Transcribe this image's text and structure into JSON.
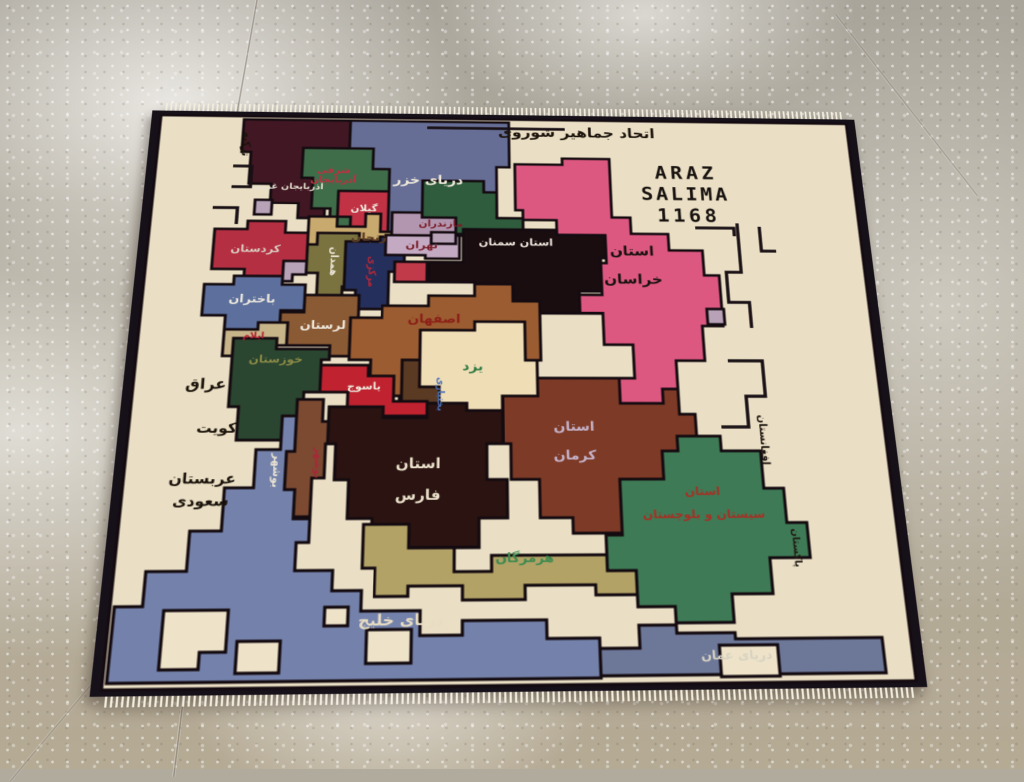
{
  "scene": {
    "floor_base_color": "#b1ab9e",
    "rug_field_color": "#eadfc4",
    "rug_border_color": "#161019",
    "fringe_color": "#f3edde"
  },
  "rug": {
    "regions": {
      "field": {
        "color": "#eadfc4"
      },
      "caspian": {
        "color": "#666e96"
      },
      "w_azerbaijan": {
        "color": "#401722"
      },
      "e_azerbaijan": {
        "color": "#3f6d4a"
      },
      "gilan": {
        "color": "#c03244"
      },
      "zanjan": {
        "color": "#c9aa6e"
      },
      "kurdistan": {
        "color": "#b52f42"
      },
      "hamadan": {
        "color": "#7a7340"
      },
      "markazi": {
        "color": "#252f5c"
      },
      "bakhtaran": {
        "color": "#5d6f9c"
      },
      "ilam": {
        "color": "#c8b489"
      },
      "lorestan": {
        "color": "#8a5a35"
      },
      "mazandaran": {
        "color": "#b295ae"
      },
      "tehran": {
        "color": "#c3a9c2"
      },
      "qom": {
        "color": "#c13a4a"
      },
      "gorgan": {
        "color": "#2f5c3c"
      },
      "semnan": {
        "color": "#190d10"
      },
      "khorasan": {
        "color": "#dd5880"
      },
      "esfahan": {
        "color": "#9a5c30"
      },
      "chaharmahal": {
        "color": "#5b3a24"
      },
      "yazd": {
        "color": "#efddb6"
      },
      "yasuj": {
        "color": "#c0232f"
      },
      "khuzestan": {
        "color": "#2a4530"
      },
      "bushehr": {
        "color": "#7b4a31"
      },
      "fars": {
        "color": "#2a1310"
      },
      "kerman": {
        "color": "#7d3a26"
      },
      "sistan": {
        "color": "#3e7a55"
      },
      "hormozgan": {
        "color": "#b2a266"
      },
      "gulf": {
        "color": "#7482ab"
      },
      "oman": {
        "color": "#6d7899"
      },
      "island": {
        "color": "#eee3c8"
      },
      "mauve_patch": {
        "color": "#b8a2b8"
      }
    },
    "labels": [
      {
        "id": "ussr",
        "text": "اتحاد جماهیر شوروی",
        "x": 465,
        "y": 24,
        "size": 17,
        "color": "#1c140c",
        "ls": 6
      },
      {
        "id": "turkey",
        "text": "ترکیه",
        "x": 104,
        "y": 42,
        "size": 12,
        "color": "#1c140c",
        "vertical": true
      },
      {
        "id": "araz-line1",
        "text": "ARAZ",
        "x": 584,
        "y": 74,
        "size": 22,
        "color": "#181310",
        "latin": true,
        "ls": 4
      },
      {
        "id": "araz-line2",
        "text": "SALIMA",
        "x": 582,
        "y": 101,
        "size": 22,
        "color": "#181310",
        "latin": true,
        "ls": 3
      },
      {
        "id": "araz-line3",
        "text": "1168",
        "x": 584,
        "y": 128,
        "size": 22,
        "color": "#181310",
        "latin": true,
        "ls": 4
      },
      {
        "id": "caspian-sea",
        "text": "دریای خزر",
        "x": 302,
        "y": 86,
        "size": 15,
        "color": "#efe9da"
      },
      {
        "id": "w-azerbaijan",
        "text": "آذربایجان غربی",
        "x": 152,
        "y": 96,
        "size": 10,
        "color": "#e8e0d2"
      },
      {
        "id": "e-azerbaijan",
        "text": "شرقی\nآذربایجان",
        "x": 200,
        "y": 80,
        "size": 11,
        "color": "#c03040"
      },
      {
        "id": "gilan",
        "text": "گیلان",
        "x": 234,
        "y": 122,
        "size": 11,
        "color": "#f0eadd"
      },
      {
        "id": "zanjan",
        "text": "زنجان",
        "x": 240,
        "y": 158,
        "size": 13,
        "color": "#5a3a22"
      },
      {
        "id": "kurdistan",
        "text": "کردستان",
        "x": 122,
        "y": 172,
        "size": 12,
        "color": "#d9cdc1"
      },
      {
        "id": "hamadan",
        "text": "همدان",
        "x": 204,
        "y": 186,
        "size": 11,
        "color": "#ece6d8",
        "vertical": true
      },
      {
        "id": "markazi",
        "text": "مرکزی",
        "x": 244,
        "y": 198,
        "size": 11,
        "color": "#b02838",
        "vertical": true
      },
      {
        "id": "bakhtaran",
        "text": "باختران",
        "x": 122,
        "y": 232,
        "size": 13,
        "color": "#ece8de"
      },
      {
        "id": "ilam",
        "text": "ایلام",
        "x": 126,
        "y": 274,
        "size": 10,
        "color": "#b02030"
      },
      {
        "id": "lorestan",
        "text": "لرستان",
        "x": 196,
        "y": 262,
        "size": 13,
        "color": "#f0e9dd"
      },
      {
        "id": "mazandaran",
        "text": "مازندران",
        "x": 316,
        "y": 140,
        "size": 11,
        "color": "#7a1f2a"
      },
      {
        "id": "tehran",
        "text": "تهران",
        "x": 296,
        "y": 166,
        "size": 12,
        "color": "#7a1f2a"
      },
      {
        "id": "semnan",
        "text": "استان سمنان",
        "x": 396,
        "y": 162,
        "size": 12,
        "color": "#efe8dc"
      },
      {
        "id": "khorasan",
        "text": "استان\nخراسان",
        "x": 520,
        "y": 188,
        "size": 16,
        "color": "#1a1210",
        "lh": 2.1
      },
      {
        "id": "esfahan",
        "text": "اصفهان",
        "x": 310,
        "y": 254,
        "size": 14,
        "color": "#8c2018"
      },
      {
        "id": "yazd",
        "text": "یزد",
        "x": 350,
        "y": 308,
        "size": 14,
        "color": "#2e7a40"
      },
      {
        "id": "chaharmahal",
        "text": "بختیاری",
        "x": 316,
        "y": 338,
        "size": 10,
        "color": "#4a6fb5",
        "vertical": true
      },
      {
        "id": "yasuj",
        "text": "یاسوج",
        "x": 240,
        "y": 330,
        "size": 11,
        "color": "#f0e8dc"
      },
      {
        "id": "khuzestan",
        "text": "خوزستان",
        "x": 150,
        "y": 300,
        "size": 12,
        "color": "#8a8a46"
      },
      {
        "id": "bushehr-strip",
        "text": "بوشهر",
        "x": 196,
        "y": 412,
        "size": 10,
        "color": "#a82838",
        "vertical": true
      },
      {
        "id": "bushehr-coast",
        "text": "بوشهر",
        "x": 157,
        "y": 420,
        "size": 11,
        "color": "#e9e2d2",
        "vertical": true
      },
      {
        "id": "fars",
        "text": "استان\nفارس",
        "x": 296,
        "y": 430,
        "size": 15,
        "color": "#ece2cc",
        "lh": 2.2
      },
      {
        "id": "kerman",
        "text": "استان\nکرمان",
        "x": 452,
        "y": 390,
        "size": 14,
        "color": "#c5b2c8",
        "lh": 2.2
      },
      {
        "id": "sistan",
        "text": "استان\nسیستان و بلوچستان",
        "x": 578,
        "y": 455,
        "size": 12,
        "color": "#a33226",
        "lh": 2.0
      },
      {
        "id": "hormozgan",
        "text": "هرمزگان",
        "x": 400,
        "y": 512,
        "size": 13,
        "color": "#3f8a50"
      },
      {
        "id": "gulf-sea",
        "text": "دریای خلیج",
        "x": 282,
        "y": 572,
        "size": 15,
        "color": "#e8ddc2"
      },
      {
        "id": "oman-sea",
        "text": "دریای عمان",
        "x": 600,
        "y": 608,
        "size": 12,
        "color": "#d8d2c2"
      },
      {
        "id": "afghanistan",
        "text": "افغانستان",
        "x": 644,
        "y": 388,
        "size": 11,
        "color": "#201812",
        "vertical": true
      },
      {
        "id": "pakistan",
        "text": "پاکستان",
        "x": 666,
        "y": 502,
        "size": 10,
        "color": "#201812",
        "vertical": true
      },
      {
        "id": "iraq",
        "text": "عراق",
        "x": 82,
        "y": 328,
        "size": 16,
        "color": "#1c140c"
      },
      {
        "id": "kuwait",
        "text": "کویت",
        "x": 96,
        "y": 376,
        "size": 15,
        "color": "#1c140c"
      },
      {
        "id": "saudi-arabia",
        "text": "عربستان\nسعودی",
        "x": 86,
        "y": 440,
        "size": 15,
        "color": "#1c140c",
        "lh": 1.5
      }
    ]
  }
}
